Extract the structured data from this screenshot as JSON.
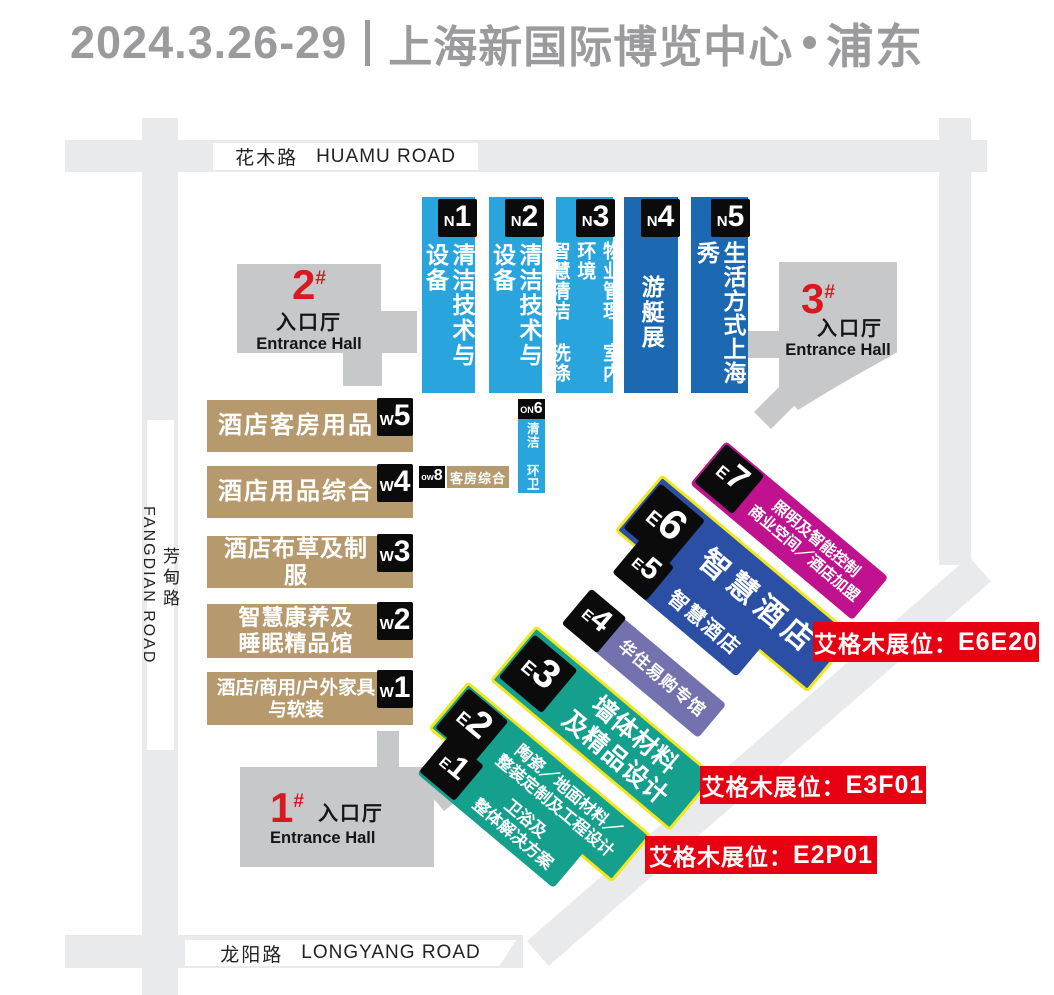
{
  "header": {
    "dates": "2024.3.26-29",
    "venue": "上海新国际博览中心",
    "district": "浦东"
  },
  "roads": {
    "top_zh": "花木路",
    "top_en": "HUAMU ROAD",
    "left_zh": "芳甸路",
    "left_en": "FANGDIAN ROAD",
    "bottom_zh": "龙阳路",
    "bottom_en": "LONGYANG ROAD"
  },
  "entrances": {
    "e1": {
      "num": "1",
      "sup": "#",
      "zh": "入口厅",
      "en": "Entrance Hall"
    },
    "e2": {
      "num": "2",
      "sup": "#",
      "zh": "入口厅",
      "en": "Entrance Hall"
    },
    "e3": {
      "num": "3",
      "sup": "#",
      "zh": "入口厅",
      "en": "Entrance Hall"
    }
  },
  "n_halls": {
    "n1": {
      "prefix": "N",
      "num": "1",
      "text": "清洁技术与设备"
    },
    "n2": {
      "prefix": "N",
      "num": "2",
      "text": "清洁技术与设备"
    },
    "n3": {
      "prefix": "N",
      "num": "3",
      "text": "物业管理 室内环境\n智慧清洁 洗涤"
    },
    "n4": {
      "prefix": "N",
      "num": "4",
      "text": "游艇展"
    },
    "n5": {
      "prefix": "N",
      "num": "5",
      "text": "生活方式上海秀"
    }
  },
  "w_halls": {
    "w5": {
      "prefix": "W",
      "num": "5",
      "text": "酒店客房用品"
    },
    "w4": {
      "prefix": "W",
      "num": "4",
      "text": "酒店用品综合"
    },
    "w3": {
      "prefix": "W",
      "num": "3",
      "text": "酒店布草及制服"
    },
    "w2": {
      "prefix": "W",
      "num": "2",
      "text": "智慧康养及\n睡眠精品馆"
    },
    "w1": {
      "prefix": "W",
      "num": "1",
      "text": "酒店/商用/户外家具\n与软装"
    }
  },
  "small_halls": {
    "on6": {
      "prefix": "ON",
      "num": "6",
      "text": "清洁 环卫"
    },
    "ow8": {
      "prefix": "ow",
      "num": "8",
      "text": "客房综合"
    }
  },
  "e_halls": {
    "e1": {
      "prefix": "E",
      "num": "1",
      "text": "卫浴及\n整体解决方案"
    },
    "e2": {
      "prefix": "E",
      "num": "2",
      "text": "陶瓷／地面材料／\n整装定制及工程设计"
    },
    "e3": {
      "prefix": "E",
      "num": "3",
      "text": "墙体材料\n及精品设计"
    },
    "e4": {
      "prefix": "E",
      "num": "4",
      "text": "华住易购专馆"
    },
    "e5": {
      "prefix": "E",
      "num": "5",
      "text": "智慧酒店"
    },
    "e6": {
      "prefix": "E",
      "num": "6",
      "text": "智慧酒店"
    },
    "e7": {
      "prefix": "E",
      "num": "7",
      "text": "照明及智能控制\n商业空间／酒店加盟"
    }
  },
  "badges": [
    {
      "label": "艾格木展位：",
      "booth": "E6E20"
    },
    {
      "label": "艾格木展位：",
      "booth": "E3F01"
    },
    {
      "label": "艾格木展位：",
      "booth": "E2P01"
    }
  ],
  "colors": {
    "title-gray": "#9b9b9d",
    "road-gray": "#e9eaeb",
    "hall-gray": "#c7c8ca",
    "light-blue": "#29a4dc",
    "dark-blue": "#1d69b1",
    "tan": "#b6996c",
    "navy": "#2a4fa5",
    "magenta": "#c0128e",
    "purple": "#7472ae",
    "teal": "#14a08d",
    "yellow": "#f2e71f",
    "red": "#e60012",
    "entrance-red": "#d71a21"
  }
}
